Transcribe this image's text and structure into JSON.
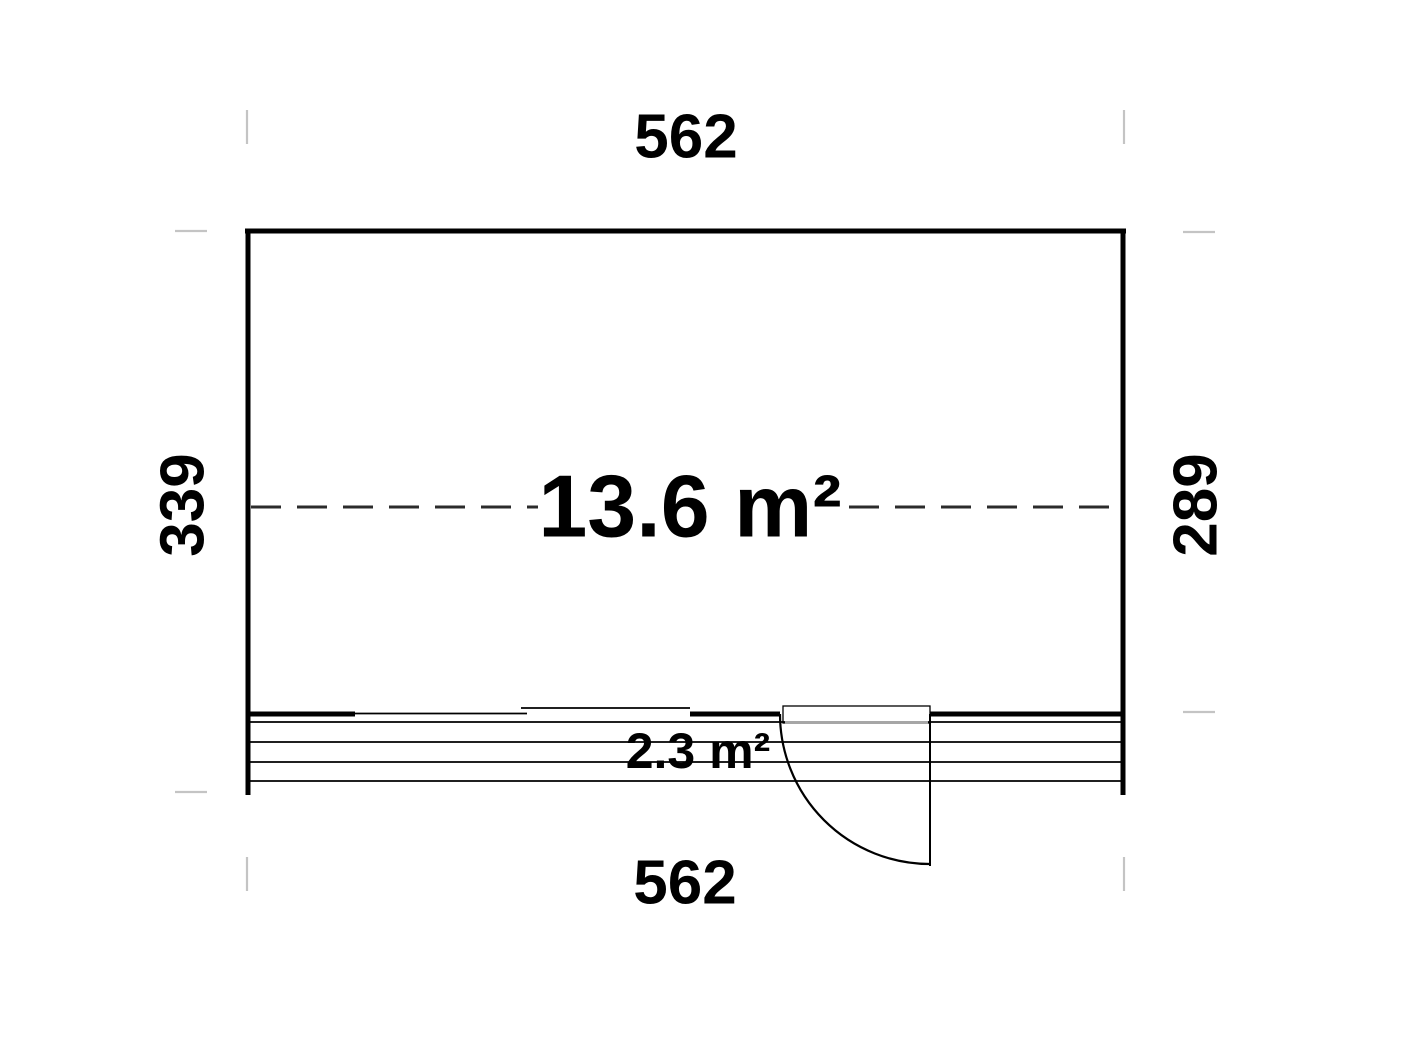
{
  "diagram": {
    "type": "floor-plan",
    "main_room": {
      "area_label": "13.6 m²"
    },
    "terrace": {
      "area_label": "2.3 m²"
    },
    "dimensions": {
      "top_width": "562",
      "bottom_width": "562",
      "left_height": "339",
      "right_height": "289"
    }
  },
  "colors": {
    "background": "#ffffff",
    "line": "#000000",
    "dash": "#2b2b2b",
    "tick": "#c4c4c4",
    "threshold": "#a6a6a6"
  }
}
